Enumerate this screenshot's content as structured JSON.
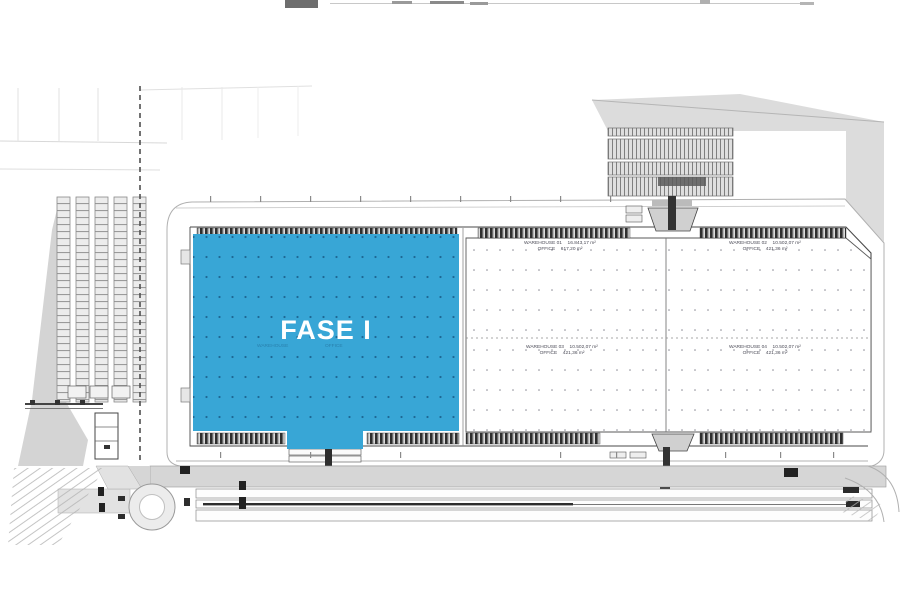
{
  "plan": {
    "phase": {
      "label": "FASE I"
    },
    "units": [
      {
        "name": "WAREHOUSE 01",
        "area": "16.843,17 m²",
        "office_label": "OFFICE",
        "office_area": "617,20 m²"
      },
      {
        "name": "WAREHOUSE 02",
        "area": "10.502,07 m²",
        "office_label": "OFFICE",
        "office_area": "421,36 m²"
      },
      {
        "name": "WAREHOUSE 03",
        "area": "10.502,07 m²",
        "office_label": "OFFICE",
        "office_area": "421,36 m²"
      },
      {
        "name": "WAREHOUSE 04",
        "area": "10.502,07 m²",
        "office_label": "OFFICE",
        "office_area": "421,36 m²"
      }
    ],
    "overprint": {
      "left": "WAREHOUSE",
      "right": "OFFICE"
    },
    "colors": {
      "phase_fill": "#38A6D6",
      "road_gray": "#d6d6d6"
    }
  }
}
